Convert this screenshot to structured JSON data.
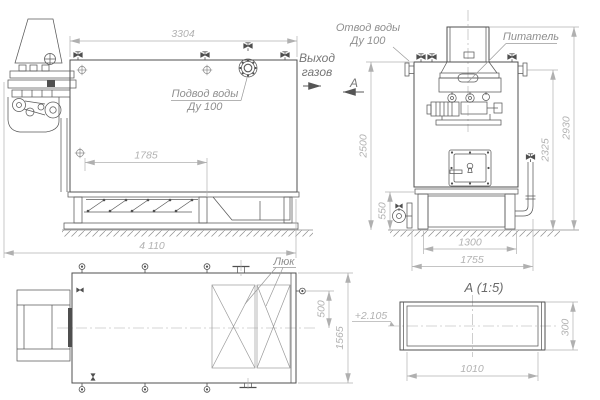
{
  "drawing": {
    "dims": {
      "d3304": "3304",
      "d1785": "1785",
      "d4110": "4 110",
      "d2500": "2500",
      "d550": "550",
      "d2325": "2325",
      "d2930": "2930",
      "d1300": "1300",
      "d1755": "1755",
      "d500": "500",
      "d1565": "1565",
      "d1010": "1010",
      "d300": "300"
    },
    "labels": {
      "water_supply_1": "Подвод воды",
      "water_supply_2": "Ду 100",
      "water_outlet_1": "Отвод воды",
      "water_outlet_2": "Ду 100",
      "gas_outlet_1": "Выход",
      "gas_outlet_2": "газов",
      "feeder": "Питатель",
      "hatch": "Люк",
      "section_letter": "А",
      "section_title": "А (1:5)",
      "elevation_mark": "+2.105"
    },
    "colors": {
      "line_main": "#4f4f4f",
      "line_thin": "#8a8a8a",
      "line_dim": "#b0b0b0",
      "text_dim": "#b2b2b2",
      "text_label": "#8f8f8f",
      "background": "#ffffff"
    }
  }
}
